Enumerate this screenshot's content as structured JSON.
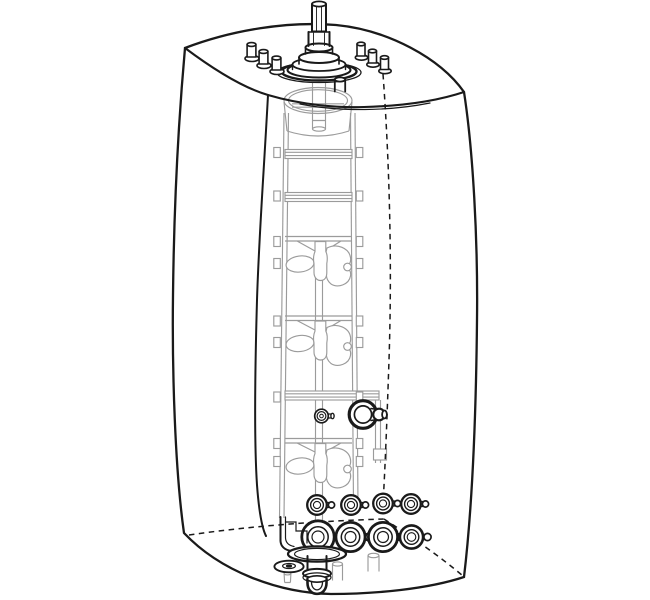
{
  "canvas": {
    "width": 650,
    "height": 600,
    "background": "#ffffff"
  },
  "palette": {
    "ink": "#1a1a1a",
    "interior_gray": "#9b9b9b",
    "paper": "#ffffff"
  },
  "diagram": {
    "kind": "technical-line-illustration",
    "subject": "transparent bioprocess vessel (single-use bioreactor bag) three-quarter view",
    "line_styles": {
      "visible_edges": "solid",
      "hidden_edges": "dashed",
      "internal_parts": "light gray"
    },
    "top_assembly": {
      "drive_shaft_coupling": 1,
      "flange_rings": 4,
      "top_ports_left_group": 3,
      "top_ports_right_group": 3,
      "front_port_below_flange": 1
    },
    "interior": {
      "funnel_cup_top": 1,
      "ladder_rails": 2,
      "plain_rungs": 3,
      "impellers": 3,
      "impeller_blades_each": 2,
      "impeller_style": "elephant-ear on center shaft",
      "side_mount_bar": 1
    },
    "mid_ports": {
      "small_probe_fitting": 1,
      "large_side_port_with_nozzle": 1
    },
    "bottom": {
      "small_port_row_count": 4,
      "large_port_row_count": 4,
      "drain_flange": 1,
      "drain_u_outlet": 1,
      "washer_grommet": 1,
      "gray_plugs_seen_through_bag": 2
    }
  }
}
